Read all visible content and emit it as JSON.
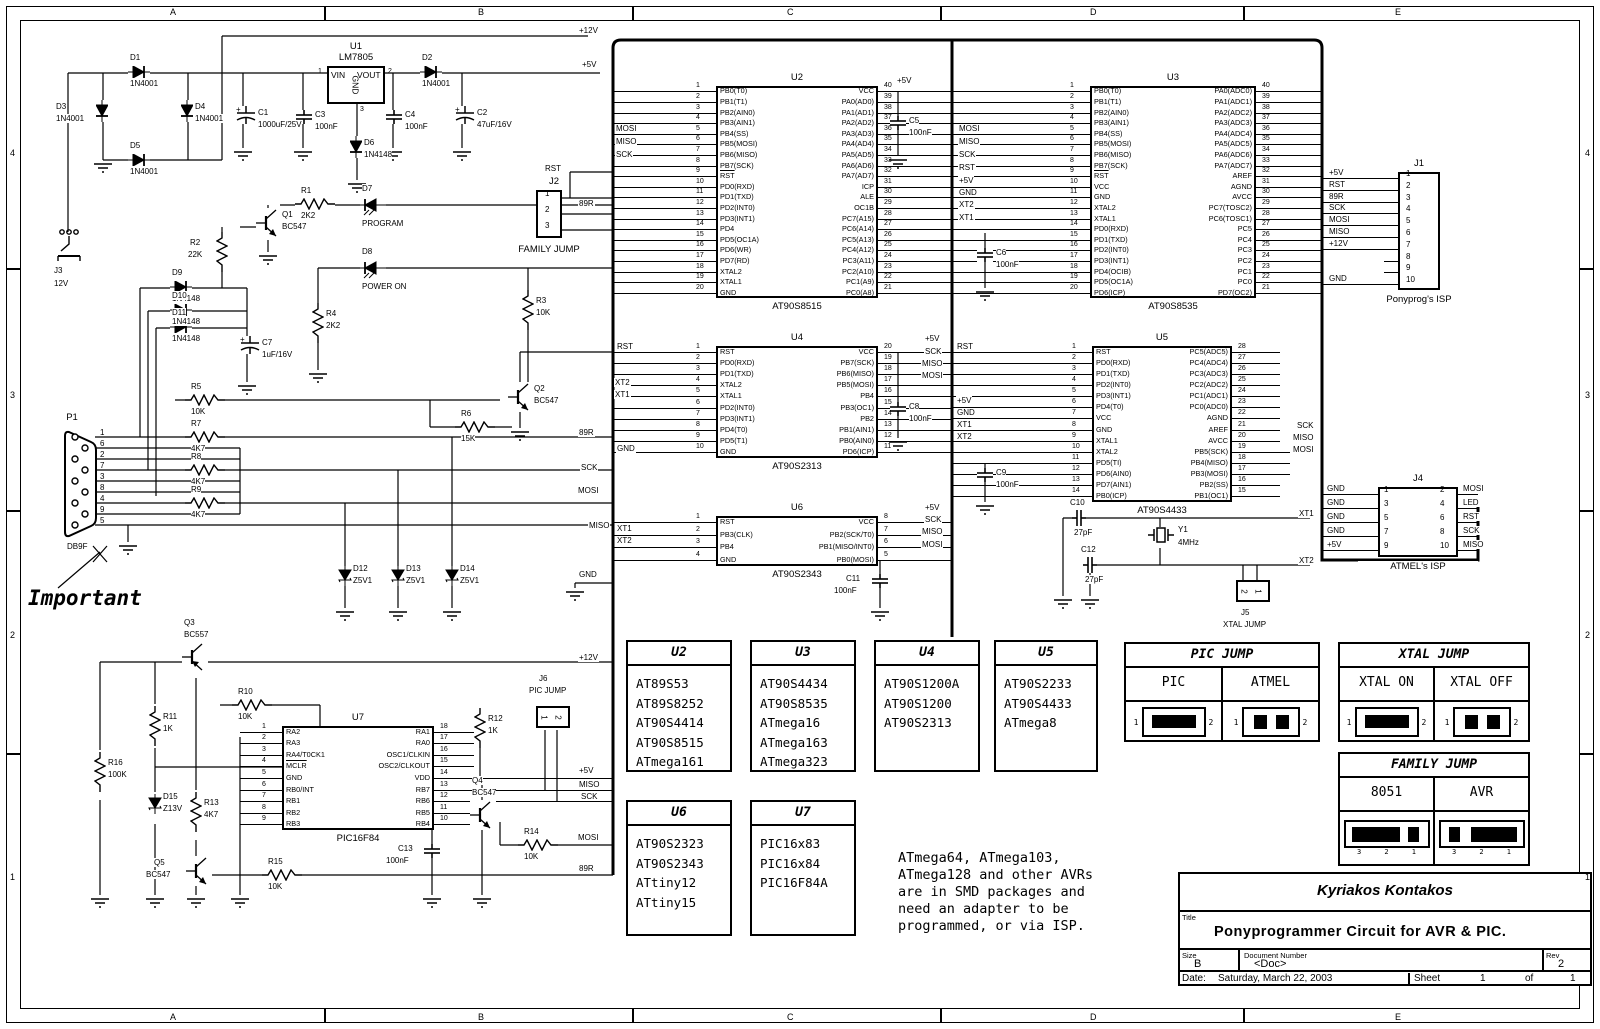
{
  "sheet": {
    "cols": [
      "A",
      "B",
      "C",
      "D",
      "E"
    ],
    "rows": [
      "4",
      "3",
      "2",
      "1"
    ]
  },
  "title_block": {
    "author": "Kyriakos Kontakos",
    "title_label": "Title",
    "title": "Ponyprogrammer Circuit for AVR & PIC.",
    "size_label": "Size",
    "size": "B",
    "doc_label": "Document Number",
    "doc": "<Doc>",
    "rev_label": "Rev",
    "rev": "2",
    "date_label": "Date:",
    "date": "Saturday, March 22, 2003",
    "sheet_label": "Sheet",
    "sheet_num": "1",
    "of_label": "of",
    "sheet_total": "1"
  },
  "note": "ATmega64, ATmega103,\nATmega128 and other AVRs\nare in SMD packages and\nneed an adapter to be\nprogrammed, or via ISP.",
  "important": "Important",
  "u1": {
    "ref": "U1",
    "part": "LM7805",
    "x": 327,
    "y": 66,
    "w": 58,
    "h": 38,
    "vin": "VIN",
    "vout": "VOUT",
    "gnd": "GND",
    "p1": "1",
    "p2": "2",
    "p3": "3"
  },
  "chips": [
    {
      "ref": "U2",
      "part": "AT90S8515",
      "x": 716,
      "y": 86,
      "w": 162,
      "h": 212,
      "lx": 613,
      "rx": 952,
      "left": [
        "PB0(T0)",
        "PB1(T1)",
        "PB2(AIN0)",
        "PB3(AIN1)",
        "PB4(SS)",
        "PB5(MOSI)",
        "PB6(MISO)",
        "PB7(SCK)",
        "RST",
        "PD0(RXD)",
        "PD1(TXD)",
        "PD2(INT0)",
        "PD3(INT1)",
        "PD4",
        "PD5(OC1A)",
        "PD6(WR)",
        "PD7(RD)",
        "XTAL2",
        "XTAL1",
        "GND"
      ],
      "right": [
        "VCC",
        "PA0(AD0)",
        "PA1(AD1)",
        "PA2(AD2)",
        "PA3(AD3)",
        "PA4(AD4)",
        "PA5(AD5)",
        "PA6(AD6)",
        "PA7(AD7)",
        "ICP",
        "ALE",
        "OC1B",
        "PC7(A15)",
        "PC6(A14)",
        "PC5(A13)",
        "PC4(A12)",
        "PC3(A11)",
        "PC2(A10)",
        "PC1(A9)",
        "PC0(A8)"
      ]
    },
    {
      "ref": "U3",
      "part": "AT90S8535",
      "x": 1090,
      "y": 86,
      "w": 166,
      "h": 212,
      "lx": 952,
      "rx": 1322,
      "left": [
        "PB0(T0)",
        "PB1(T1)",
        "PB2(AIN0)",
        "PB3(AIN1)",
        "PB4(SS)",
        "PB5(MOSI)",
        "PB6(MISO)",
        "PB7(SCK)",
        "RST",
        "VCC",
        "GND",
        "XTAL2",
        "XTAL1",
        "PD0(RXD)",
        "PD1(TXD)",
        "PD2(INT0)",
        "PD3(INT1)",
        "PD4(OCIB)",
        "PD5(OC1A)",
        "PD6(ICP)"
      ],
      "right": [
        "PA0(ADC0)",
        "PA1(ADC1)",
        "PA2(ADC2)",
        "PA3(ADC3)",
        "PA4(ADC4)",
        "PA5(ADC5)",
        "PA6(ADC6)",
        "PA7(ADC7)",
        "AREF",
        "AGND",
        "AVCC",
        "PC7(TOSC2)",
        "PC6(TOSC1)",
        "PC5",
        "PC4",
        "PC3",
        "PC2",
        "PC1",
        "PC0",
        "PD7(OC2)"
      ]
    },
    {
      "ref": "U4",
      "part": "AT90S2313",
      "x": 716,
      "y": 346,
      "w": 162,
      "h": 112,
      "lx": 613,
      "rx": 952,
      "left": [
        "RST",
        "PD0(RXD)",
        "PD1(TXD)",
        "XTAL2",
        "XTAL1",
        "PD2(INT0)",
        "PD3(INT1)",
        "PD4(T0)",
        "PD5(T1)",
        "GND"
      ],
      "right": [
        "VCC",
        "PB7(SCK)",
        "PB6(MISO)",
        "PB5(MOSI)",
        "PB4",
        "PB3(OC1)",
        "PB2",
        "PB1(AIN1)",
        "PB0(AIN0)",
        "PD6(ICP)"
      ]
    },
    {
      "ref": "U5",
      "part": "AT90S4433",
      "x": 1092,
      "y": 346,
      "w": 140,
      "h": 156,
      "lx": 952,
      "rxe": 48,
      "long": [
        9,
        10,
        11
      ],
      "longx": 1290,
      "left": [
        "RST",
        "PD0(RXD)",
        "PD1(TXD)",
        "PD2(INT0)",
        "PD3(INT1)",
        "PD4(T0)",
        "VCC",
        "GND",
        "XTAL1",
        "XTAL2",
        "PD5(TI)",
        "PD6(AIN0)",
        "PD7(AIN1)",
        "PB0(ICP)"
      ],
      "right": [
        "PC5(ADC5)",
        "PC4(ADC4)",
        "PC3(ADC3)",
        "PC2(ADC2)",
        "PC1(ADC1)",
        "PC0(ADC0)",
        "AGND",
        "AREF",
        "AVCC",
        "PB5(SCK)",
        "PB4(MISO)",
        "PB3(MOSI)",
        "PB2(SS)",
        "PB1(OC1)"
      ]
    },
    {
      "ref": "U6",
      "part": "AT90S2343",
      "x": 716,
      "y": 516,
      "w": 162,
      "h": 50,
      "lx": 613,
      "rx": 952,
      "left": [
        "RST",
        "PB3(CLK)",
        "PB4",
        "GND"
      ],
      "right": [
        "VCC",
        "PB2(SCK/T0)",
        "PB1(MISO/INT0)",
        "PB0(MOSI)"
      ]
    },
    {
      "ref": "U7",
      "part": "PIC16F84",
      "x": 282,
      "y": 726,
      "w": 152,
      "h": 104,
      "lxe": 42,
      "rxe": 40,
      "long": [
        4,
        5,
        6
      ],
      "longx": 613,
      "left": [
        "RA2",
        "RA3",
        "RA4/T0CK1",
        "MCLR",
        "GND",
        "RB0/INT",
        "RB1",
        "RB2",
        "RB3"
      ],
      "right": [
        "RA1",
        "RA0",
        "OSC1/CLKIN",
        "OSC2/CLKOUT",
        "VDD",
        "RB7",
        "RB6",
        "RB5",
        "RB4"
      ]
    }
  ],
  "j1": {
    "ref": "J1",
    "caption": "Ponyprog's ISP",
    "x": 1398,
    "y": 172,
    "w": 42,
    "h": 118,
    "pins": [
      "1",
      "2",
      "3",
      "4",
      "5",
      "6",
      "7",
      "8",
      "9",
      "10"
    ],
    "left_labels": [
      "+5V",
      "RST",
      "89R",
      "SCK",
      "MOSI",
      "MISO",
      "+12V",
      "",
      "",
      "GND"
    ]
  },
  "j2": {
    "ref": "J2",
    "caption": "FAMILY JUMP",
    "x": 536,
    "y": 190,
    "w": 26,
    "h": 48,
    "pins": [
      "1",
      "2",
      "3"
    ]
  },
  "j4": {
    "ref": "J4",
    "caption": "ATMEL's ISP",
    "x": 1378,
    "y": 487,
    "w": 80,
    "h": 70,
    "left_pins": [
      "1",
      "3",
      "5",
      "7",
      "9"
    ],
    "right_pins": [
      "2",
      "4",
      "6",
      "8",
      "10"
    ],
    "left_labels": [
      "GND",
      "GND",
      "GND",
      "GND",
      "+5V"
    ],
    "right_labels": [
      "MOSI",
      "LED",
      "RST",
      "SCK",
      "MISO"
    ]
  },
  "j5": {
    "ref": "J5",
    "caption": "XTAL JUMP",
    "x": 1236,
    "y": 580,
    "pins": [
      "2",
      "1"
    ]
  },
  "j6": {
    "ref": "J6",
    "caption": "PIC JUMP",
    "x": 536,
    "y": 706,
    "pins": [
      "1",
      "2"
    ]
  },
  "p1": {
    "ref": "P1",
    "caption": "DB9F",
    "x": 64,
    "y": 428,
    "pins": [
      "1",
      "6",
      "2",
      "7",
      "3",
      "8",
      "4",
      "9",
      "5"
    ]
  },
  "j3": {
    "ref": "J3",
    "caption": "12V",
    "x": 55,
    "y": 228
  },
  "parts": [
    {
      "t": "dh",
      "x": 128,
      "y": 66,
      "r": "D1",
      "v": "1N4001"
    },
    {
      "t": "dv",
      "x": 96,
      "y": 100,
      "r": "D3",
      "v": "1N4001",
      "lp": "l"
    },
    {
      "t": "dv",
      "x": 181,
      "y": 100,
      "r": "D4",
      "v": "1N4001"
    },
    {
      "t": "dh",
      "x": 128,
      "y": 154,
      "r": "D5",
      "v": "1N4001"
    },
    {
      "t": "cpol",
      "x": 236,
      "y": 106,
      "r": "C1",
      "v": "1000uF/25V"
    },
    {
      "t": "cap",
      "x": 296,
      "y": 110,
      "r": "C3",
      "v": "100nF"
    },
    {
      "t": "dv",
      "x": 350,
      "y": 136,
      "r": "D6",
      "v": "1N4148"
    },
    {
      "t": "cap",
      "x": 386,
      "y": 110,
      "r": "C4",
      "v": "100nF"
    },
    {
      "t": "dh",
      "x": 420,
      "y": 66,
      "r": "D2",
      "v": "1N4001"
    },
    {
      "t": "cpol",
      "x": 455,
      "y": 106,
      "r": "C2",
      "v": "47uF/16V"
    },
    {
      "t": "rh",
      "x": 295,
      "y": 198,
      "r": "R1",
      "v": "2K2"
    },
    {
      "t": "led",
      "x": 360,
      "y": 197,
      "r": "D7",
      "v": "PROGRAM"
    },
    {
      "t": "npn",
      "x": 256,
      "y": 208,
      "r": "Q1",
      "v": "BC547"
    },
    {
      "t": "rv",
      "x": 216,
      "y": 232,
      "r": "R2",
      "v": "22K",
      "lp": "l"
    },
    {
      "t": "led",
      "x": 360,
      "y": 260,
      "r": "D8",
      "v": "POWER ON"
    },
    {
      "t": "dh",
      "x": 170,
      "y": 281,
      "r": "D9",
      "v": "1N4148"
    },
    {
      "t": "dh",
      "x": 170,
      "y": 304,
      "r": "D10",
      "v": "1N4148"
    },
    {
      "t": "dh",
      "x": 170,
      "y": 321,
      "r": "D11",
      "v": "1N4148"
    },
    {
      "t": "cpol",
      "x": 240,
      "y": 336,
      "r": "C7",
      "v": "1uF/16V"
    },
    {
      "t": "rv",
      "x": 312,
      "y": 303,
      "r": "R4",
      "v": "2K2"
    },
    {
      "t": "rv",
      "x": 522,
      "y": 290,
      "r": "R3",
      "v": "10K"
    },
    {
      "t": "npn",
      "x": 508,
      "y": 382,
      "r": "Q2",
      "v": "BC547"
    },
    {
      "t": "rh",
      "x": 185,
      "y": 394,
      "r": "R5",
      "v": "10K"
    },
    {
      "t": "rh",
      "x": 455,
      "y": 421,
      "r": "R6",
      "v": "15K"
    },
    {
      "t": "rh",
      "x": 185,
      "y": 431,
      "r": "R7",
      "v": "4K7"
    },
    {
      "t": "rh",
      "x": 185,
      "y": 464,
      "r": "R8",
      "v": "4K7"
    },
    {
      "t": "rh",
      "x": 185,
      "y": 497,
      "r": "R9",
      "v": "4K7"
    },
    {
      "t": "zen",
      "x": 338,
      "y": 566,
      "r": "D12",
      "v": "Z5V1"
    },
    {
      "t": "zen",
      "x": 391,
      "y": 566,
      "r": "D13",
      "v": "Z5V1"
    },
    {
      "t": "zen",
      "x": 445,
      "y": 566,
      "r": "D14",
      "v": "Z5V1"
    },
    {
      "t": "cap",
      "x": 890,
      "y": 116,
      "r": "C5",
      "v": "100nF"
    },
    {
      "t": "cap",
      "x": 977,
      "y": 248,
      "r": "C6",
      "v": "100nF"
    },
    {
      "t": "cap",
      "x": 890,
      "y": 402,
      "r": "C8",
      "v": "100nF"
    },
    {
      "t": "cap",
      "x": 977,
      "y": 468,
      "r": "C9",
      "v": "100nF"
    },
    {
      "t": "cap",
      "x": 872,
      "y": 574,
      "r": "C11",
      "v": "100nF",
      "lp": "l"
    },
    {
      "t": "caph",
      "x": 1072,
      "y": 510,
      "r": "C10",
      "v": "27pF"
    },
    {
      "t": "caph",
      "x": 1083,
      "y": 557,
      "r": "C12",
      "v": "27pF"
    },
    {
      "t": "xtal",
      "x": 1148,
      "y": 527,
      "r": "Y1",
      "v": "4MHz"
    },
    {
      "t": "pnp",
      "x": 182,
      "y": 642,
      "r": "Q3",
      "v": "BC557",
      "lp": "a"
    },
    {
      "t": "rh",
      "x": 232,
      "y": 699,
      "r": "R10",
      "v": "10K"
    },
    {
      "t": "rv",
      "x": 149,
      "y": 706,
      "r": "R11",
      "v": "1K"
    },
    {
      "t": "rv",
      "x": 94,
      "y": 752,
      "r": "R16",
      "v": "100K"
    },
    {
      "t": "zen",
      "x": 148,
      "y": 794,
      "r": "D15",
      "v": "Z13V"
    },
    {
      "t": "rv",
      "x": 190,
      "y": 792,
      "r": "R13",
      "v": "4K7"
    },
    {
      "t": "rv",
      "x": 474,
      "y": 708,
      "r": "R12",
      "v": "1K"
    },
    {
      "t": "npn",
      "x": 470,
      "y": 800,
      "r": "Q4",
      "v": "BC547",
      "lp": "a"
    },
    {
      "t": "cap",
      "x": 424,
      "y": 844,
      "r": "C13",
      "v": "100nF",
      "lp": "l"
    },
    {
      "t": "rh",
      "x": 518,
      "y": 839,
      "r": "R14",
      "v": "10K"
    },
    {
      "t": "npn",
      "x": 186,
      "y": 856,
      "r": "Q5",
      "v": "BC547",
      "lp": "l"
    },
    {
      "t": "rh",
      "x": 262,
      "y": 869,
      "r": "R15",
      "v": "10K"
    }
  ],
  "grounds": [
    [
      94,
      162
    ],
    [
      234,
      150
    ],
    [
      294,
      150
    ],
    [
      384,
      150
    ],
    [
      453,
      150
    ],
    [
      348,
      182
    ],
    [
      259,
      254
    ],
    [
      238,
      384
    ],
    [
      309,
      372
    ],
    [
      511,
      430
    ],
    [
      119,
      544
    ],
    [
      336,
      610
    ],
    [
      389,
      610
    ],
    [
      443,
      610
    ],
    [
      889,
      158
    ],
    [
      976,
      290
    ],
    [
      889,
      440
    ],
    [
      976,
      504
    ],
    [
      871,
      610
    ],
    [
      566,
      590
    ],
    [
      1054,
      598
    ],
    [
      1081,
      598
    ],
    [
      91,
      897
    ],
    [
      146,
      897
    ],
    [
      187,
      897
    ],
    [
      231,
      897
    ],
    [
      423,
      897
    ],
    [
      473,
      897
    ]
  ],
  "net_labels": [
    [
      578,
      26,
      "+12V"
    ],
    [
      581,
      60,
      "+5V"
    ],
    [
      615,
      124,
      "MOSI"
    ],
    [
      615,
      137,
      "MISO"
    ],
    [
      615,
      150,
      "SCK"
    ],
    [
      544,
      164,
      "RST"
    ],
    [
      578,
      199,
      "89R"
    ],
    [
      896,
      76,
      "+5V"
    ],
    [
      958,
      124,
      "MOSI"
    ],
    [
      958,
      137,
      "MISO"
    ],
    [
      958,
      150,
      "SCK"
    ],
    [
      958,
      163,
      "RST"
    ],
    [
      958,
      176,
      "+5V"
    ],
    [
      958,
      188,
      "GND"
    ],
    [
      958,
      200,
      "XT2"
    ],
    [
      958,
      213,
      "XT1"
    ],
    [
      616,
      342,
      "RST"
    ],
    [
      614,
      378,
      "XT2"
    ],
    [
      614,
      390,
      "XT1"
    ],
    [
      616,
      444,
      "GND"
    ],
    [
      924,
      334,
      "+5V"
    ],
    [
      924,
      347,
      "SCK"
    ],
    [
      921,
      359,
      "MISO"
    ],
    [
      921,
      371,
      "MOSI"
    ],
    [
      956,
      342,
      "RST"
    ],
    [
      956,
      396,
      "+5V"
    ],
    [
      956,
      408,
      "GND"
    ],
    [
      956,
      420,
      "XT1"
    ],
    [
      956,
      432,
      "XT2"
    ],
    [
      1296,
      421,
      "SCK"
    ],
    [
      1292,
      433,
      "MISO"
    ],
    [
      1292,
      445,
      "MOSI"
    ],
    [
      924,
      503,
      "+5V"
    ],
    [
      924,
      515,
      "SCK"
    ],
    [
      921,
      527,
      "MISO"
    ],
    [
      921,
      540,
      "MOSI"
    ],
    [
      616,
      524,
      "XT1"
    ],
    [
      616,
      536,
      "XT2"
    ],
    [
      578,
      428,
      "89R"
    ],
    [
      580,
      463,
      "SCK"
    ],
    [
      577,
      486,
      "MOSI"
    ],
    [
      588,
      521,
      "MISO"
    ],
    [
      578,
      570,
      "GND"
    ],
    [
      1298,
      509,
      "XT1"
    ],
    [
      1298,
      556,
      "XT2"
    ],
    [
      578,
      653,
      "+12V"
    ],
    [
      578,
      766,
      "+5V"
    ],
    [
      578,
      780,
      "MISO"
    ],
    [
      580,
      792,
      "SCK"
    ],
    [
      577,
      833,
      "MOSI"
    ],
    [
      578,
      864,
      "89R"
    ]
  ],
  "chip_tables": [
    {
      "t": "U2",
      "x": 626,
      "y": 640,
      "w": 106,
      "h": 132,
      "items": [
        "AT89S53",
        "AT89S8252",
        "AT90S4414",
        "AT90S8515",
        "ATmega161"
      ]
    },
    {
      "t": "U3",
      "x": 750,
      "y": 640,
      "w": 106,
      "h": 132,
      "items": [
        "AT90S4434",
        "AT90S8535",
        "ATmega16",
        "ATmega163",
        "ATmega323"
      ]
    },
    {
      "t": "U4",
      "x": 874,
      "y": 640,
      "w": 106,
      "h": 132,
      "items": [
        "AT90S1200A",
        "AT90S1200",
        "AT90S2313"
      ]
    },
    {
      "t": "U5",
      "x": 994,
      "y": 640,
      "w": 104,
      "h": 132,
      "items": [
        "AT90S2233",
        "AT90S4433",
        "ATmega8"
      ]
    },
    {
      "t": "U6",
      "x": 626,
      "y": 800,
      "w": 106,
      "h": 136,
      "items": [
        "AT90S2323",
        "AT90S2343",
        "ATtiny12",
        "ATtiny15"
      ]
    },
    {
      "t": "U7",
      "x": 750,
      "y": 800,
      "w": 106,
      "h": 136,
      "items": [
        "PIC16x83",
        "PIC16x84",
        "PIC16F84A"
      ]
    }
  ],
  "jumper_tables": [
    {
      "t": "PIC JUMP",
      "x": 1124,
      "y": 642,
      "w": 196,
      "h": 100,
      "cols": [
        {
          "label": "PIC",
          "jmp": "bar",
          "pins": [
            "1",
            "2"
          ]
        },
        {
          "label": "ATMEL",
          "jmp": "dots",
          "pins": [
            "1",
            "2"
          ]
        }
      ]
    },
    {
      "t": "XTAL JUMP",
      "x": 1338,
      "y": 642,
      "w": 192,
      "h": 100,
      "cols": [
        {
          "label": "XTAL ON",
          "jmp": "bar",
          "pins": [
            "1",
            "2"
          ]
        },
        {
          "label": "XTAL OFF",
          "jmp": "dots",
          "pins": [
            "1",
            "2"
          ]
        }
      ]
    },
    {
      "t": "FAMILY JUMP",
      "x": 1338,
      "y": 752,
      "w": 192,
      "h": 114,
      "cols": [
        {
          "label": "8051",
          "jmp": "bar32",
          "pins": [
            "3",
            "2",
            "1"
          ]
        },
        {
          "label": "AVR",
          "jmp": "bar21",
          "pins": [
            "3",
            "2",
            "1"
          ]
        }
      ]
    }
  ]
}
